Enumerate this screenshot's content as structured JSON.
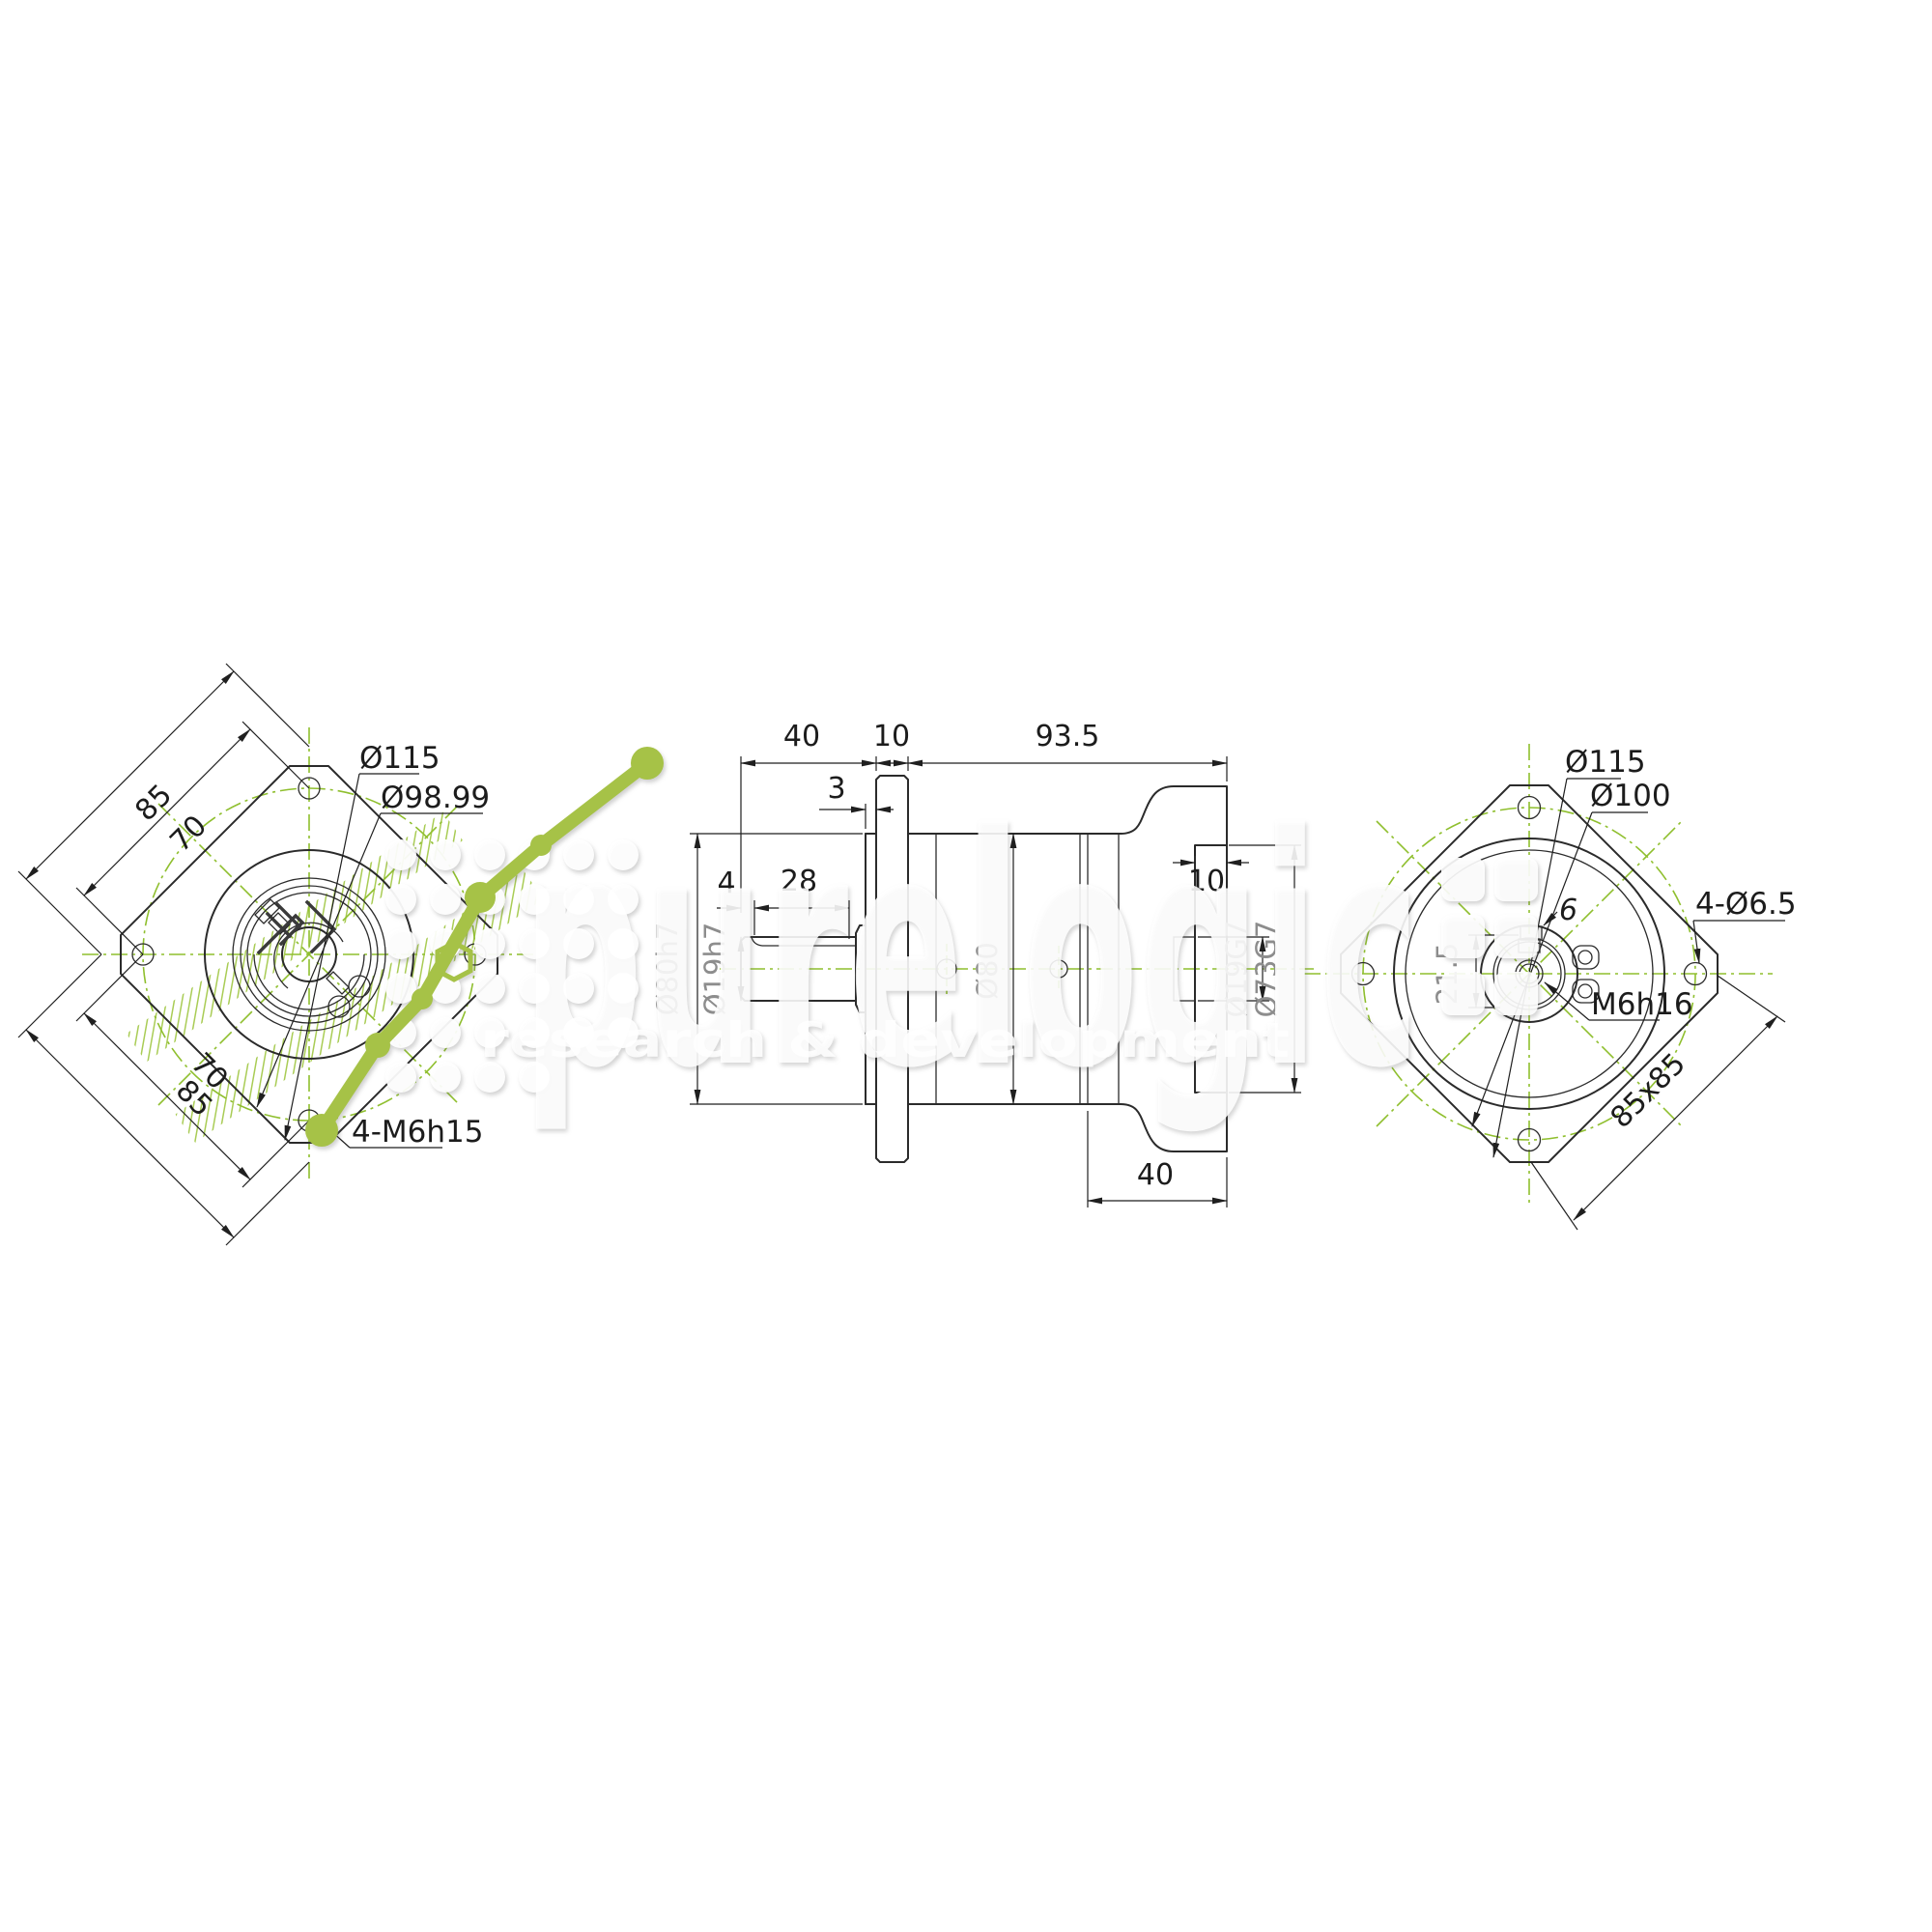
{
  "drawing": {
    "type": "engineering-drawing",
    "subject": "planetary gearbox / servo flange, three orthographic views",
    "colors": {
      "line": "#2b2b2b",
      "centerline_green": "#8fbf2e",
      "hatch_green": "#a9cc55",
      "logo_green": "#a6c247",
      "faded_label": "#8d8d8d"
    },
    "left_view": {
      "dim_top_85": "85",
      "dim_top_70": "70",
      "dim_bot_70": "70",
      "dim_bot_85": "85",
      "label_d115": "Ø115",
      "label_d9899": "Ø98.99",
      "label_bolts": "4-M6h15"
    },
    "middle_view": {
      "dim_40_top": "40",
      "dim_10_top": "10",
      "dim_935_top": "93.5",
      "dim_3": "3",
      "dim_4": "4",
      "dim_28": "28",
      "label_d80h7": "Ø80h7",
      "label_d19h7": "Ø19h7",
      "label_d80": "Ø80",
      "dim_10_pilot": "10",
      "label_d19g7": "Ø19G7",
      "label_d73g7": "Ø73G7",
      "dim_40_bottom": "40"
    },
    "right_view": {
      "label_d115": "Ø115",
      "label_d100": "Ø100",
      "label_bolts": "4-Ø6.5",
      "dim_215": "21.5",
      "dim_6": "6",
      "label_thread": "M6h16",
      "dim_85x85": "85x85"
    },
    "watermark": {
      "brand": "purelogic",
      "tagline": "research & development"
    }
  }
}
